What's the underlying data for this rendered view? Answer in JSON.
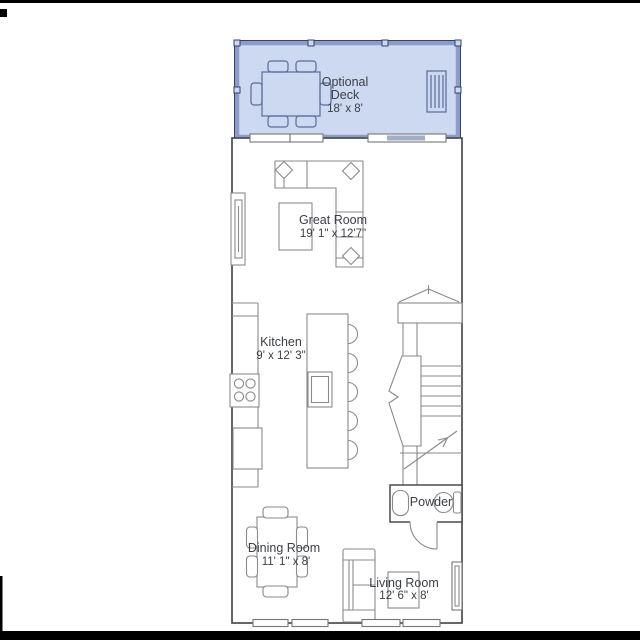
{
  "plan": {
    "deck": {
      "line1": "Optional",
      "line2": "Deck",
      "dims": "18' x 8'"
    },
    "great_room": {
      "name": "Great Room",
      "dims": "19' 1\" x 12'7\""
    },
    "kitchen": {
      "name": "Kitchen",
      "dims": "9' x 12' 3\""
    },
    "powder": {
      "name": "Powder"
    },
    "dining_room": {
      "name": "Dining Room",
      "dims": "11' 1\" x 8'"
    },
    "living_room": {
      "name": "Living Room",
      "dims": "12' 6\" x 8'"
    }
  },
  "colors": {
    "page_bg": "#ffffff",
    "deck_fill": "#cdd9f1",
    "deck_band": "#8b9cc6",
    "deck_edge": "#35406b",
    "deck_item_line": "#5a6b99",
    "wall_line": "#4c4c4c",
    "furniture_line": "#8a8a8a",
    "text_color": "#3b3f45",
    "frame_mark": "#000000",
    "door_shade": "#a2adc7"
  }
}
